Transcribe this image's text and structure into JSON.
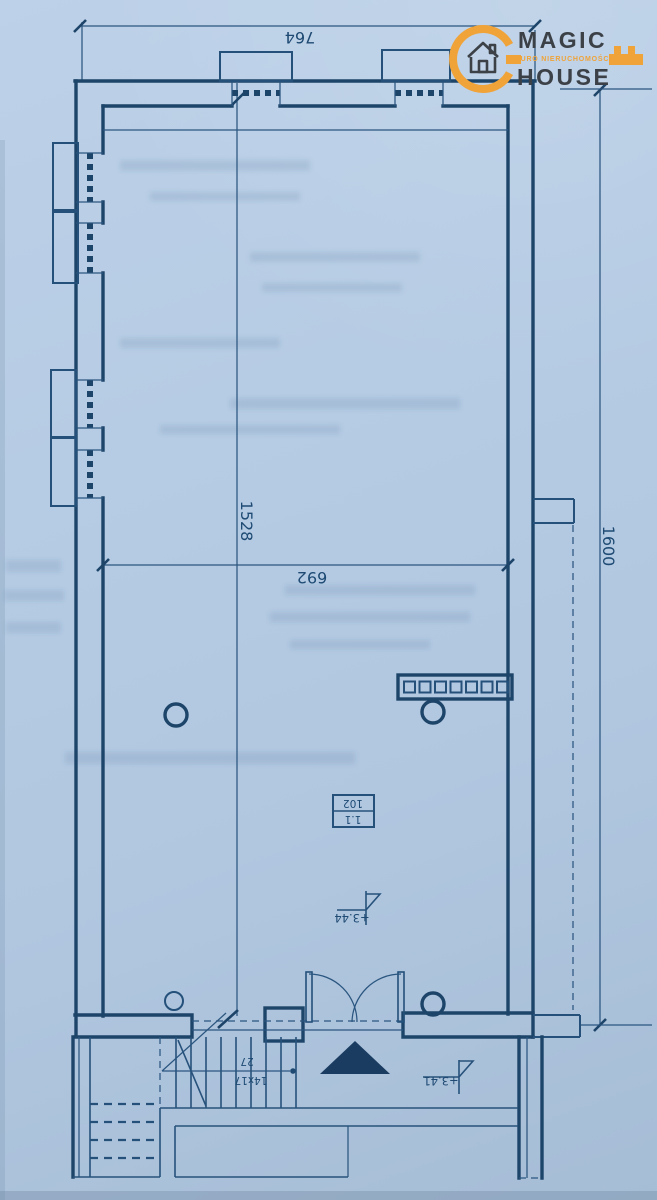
{
  "logo": {
    "line1": "MAGIC",
    "line2": "HOUSE",
    "tagline": "BIURO NIERUCHOMOŚCI",
    "accent_color": "#F0A339",
    "text_color": "#3C4147"
  },
  "plan": {
    "ink_color": "#1E4A73",
    "paper_color": "#B5CBE3",
    "dim_top": "764",
    "dim_height": "1528",
    "dim_interior_width": "692",
    "dim_right": "1600",
    "room": {
      "number": "1.1",
      "code": "102"
    },
    "level_upper": "+3.44",
    "level_lower": "+3.41",
    "stair_tread": "27",
    "stair_riser": "14x17"
  }
}
